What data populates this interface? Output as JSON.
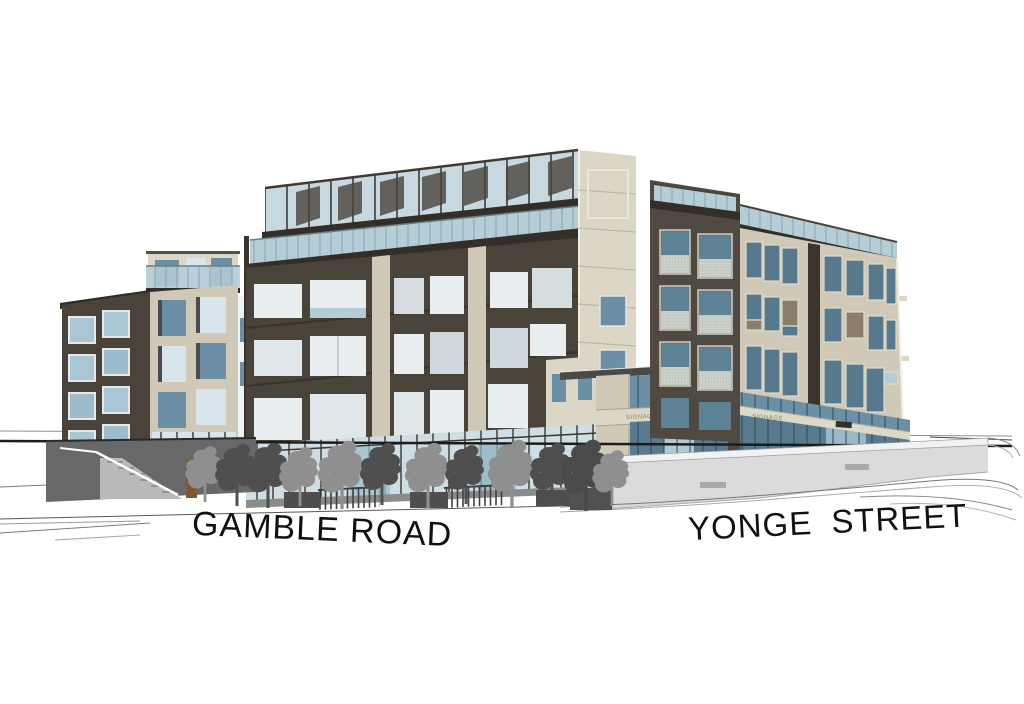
{
  "scene": {
    "title": "Architectural massing rendering",
    "setting": "Mixed-use mid-rise development at the corner of Gamble Road and Yonge Street",
    "style": "3D massing model on white ground with perspective street lines",
    "background_color": "#ffffff"
  },
  "streets": {
    "left": {
      "label": "GAMBLE ROAD"
    },
    "right": {
      "label": "YONGE STREET"
    }
  },
  "signage": {
    "corner_pavilion": "SIGNAGE",
    "yonge_retail": "SIGNAGE"
  },
  "buildings": {
    "west_block": {
      "name": "West residential block",
      "storeys_visible": 5
    },
    "centre_block": {
      "name": "Centre block with rooftop terraces",
      "storeys_visible": 6,
      "features": [
        "rooftop glass railing",
        "glass balcony band",
        "retail storefront with street trees"
      ]
    },
    "east_block": {
      "name": "Yonge Street block",
      "storeys_visible": 6,
      "features": [
        "dark corner tower",
        "retail storefront with signage band"
      ]
    }
  },
  "colors": {
    "dark_facade": "#49433a",
    "beige_facade": "#d0c9b7",
    "glass_blue": "#6b90a6",
    "railing_glass": "#b4cdd7",
    "tree_gray": "#8f8f8f",
    "ground_line": "#1c1c1c",
    "light_wall": "#dbdbdb"
  }
}
